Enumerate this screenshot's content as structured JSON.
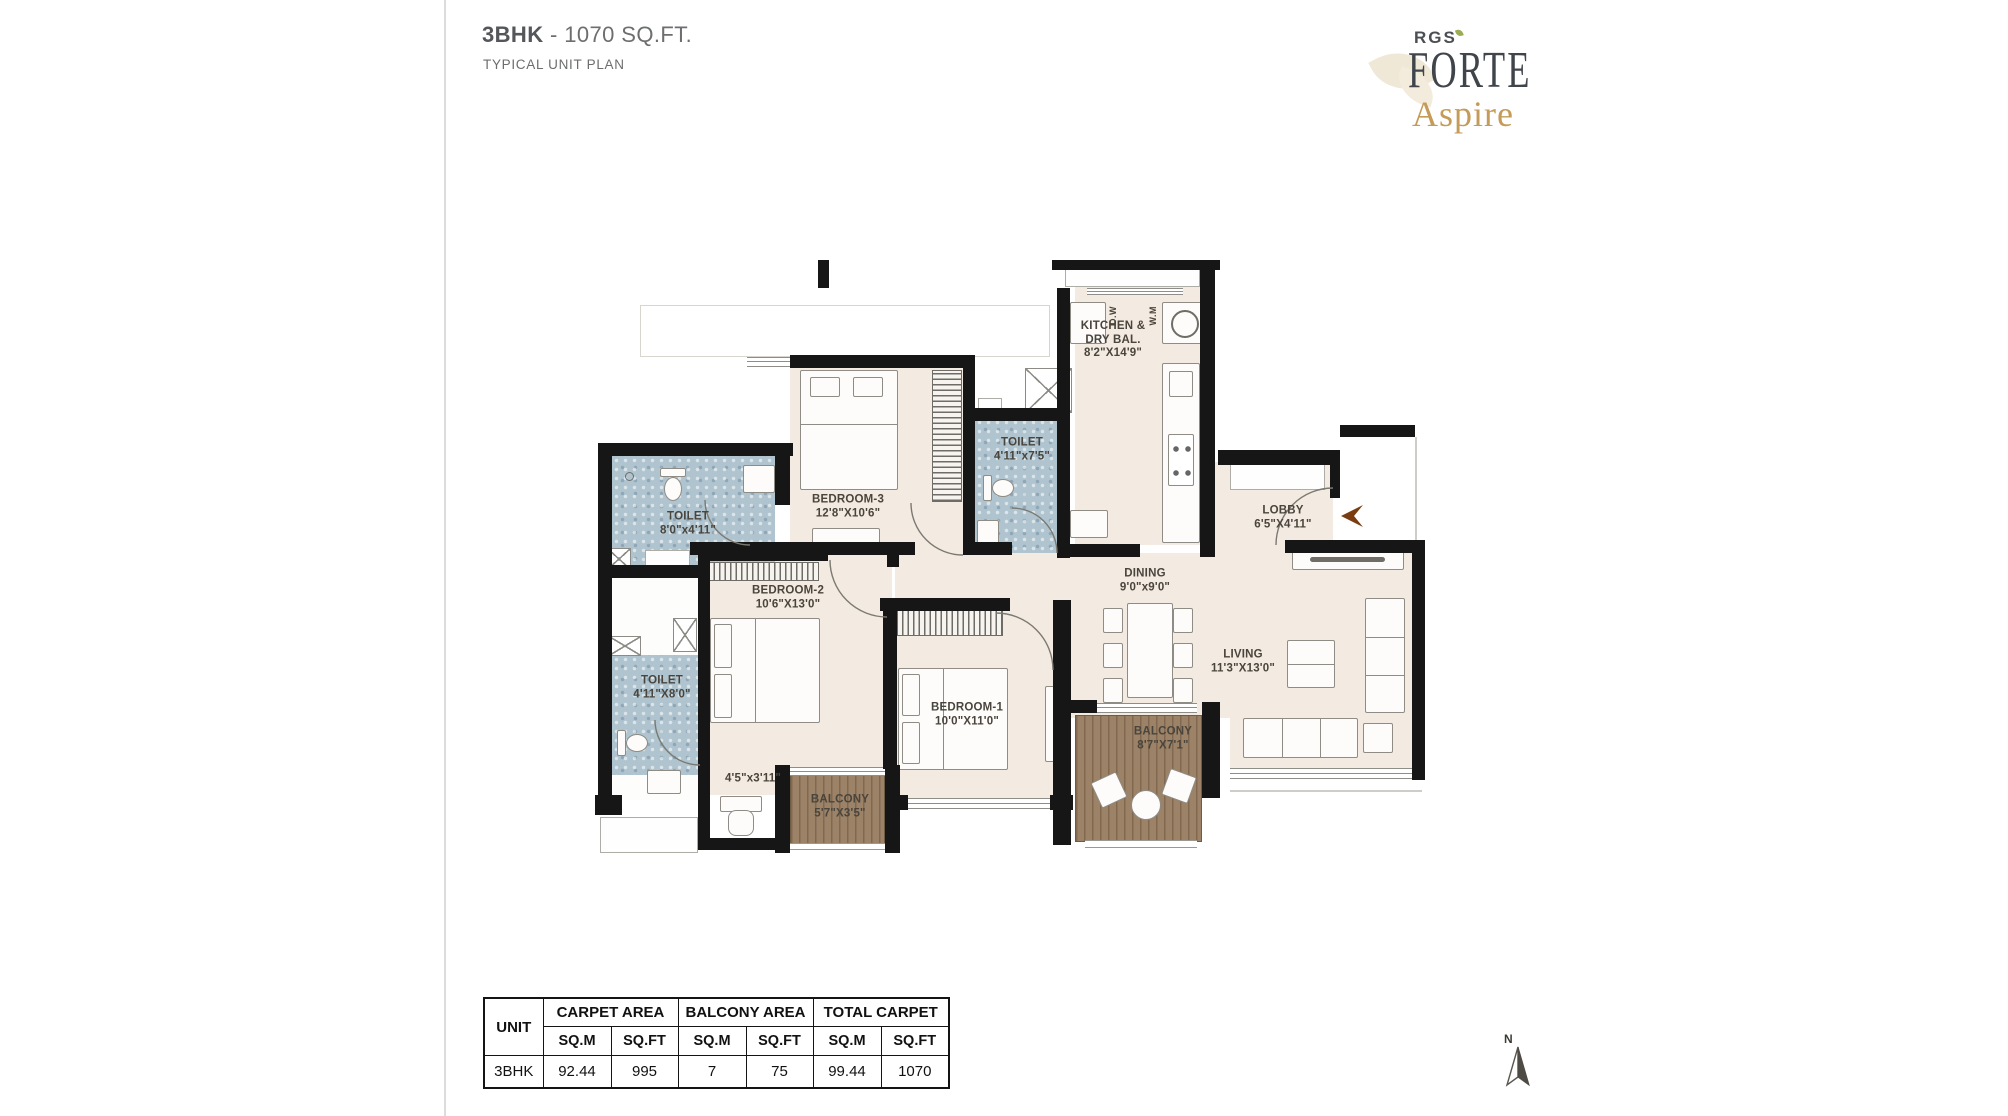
{
  "page": {
    "title_unit": "3BHK",
    "title_area": "- 1070 SQ.FT.",
    "subtitle": "TYPICAL UNIT PLAN"
  },
  "logo": {
    "rgs": "RGS",
    "forte": "FORTE",
    "aspire": "Aspire"
  },
  "plan": {
    "rooms": {
      "kitchen": {
        "line1": "KITCHEN &",
        "line2": "DRY BAL.",
        "dim": "8'2\"X14'9\""
      },
      "lobby": {
        "line1": "LOBBY",
        "dim": "6'5\"X4'11\""
      },
      "toilet_common": {
        "line1": "TOILET",
        "dim": "4'11\"x7'5\""
      },
      "bedroom3": {
        "line1": "BEDROOM-3",
        "dim": "12'8\"X10'6\""
      },
      "toilet_bed3": {
        "line1": "TOILET",
        "dim": "8'0\"x4'11\""
      },
      "bedroom2": {
        "line1": "BEDROOM-2",
        "dim": "10'6\"X13'0\""
      },
      "toilet_bed2": {
        "line1": "TOILET",
        "dim": "4'11\"X8'0\""
      },
      "dining": {
        "line1": "DINING",
        "dim": "9'0\"x9'0\""
      },
      "living": {
        "line1": "LIVING",
        "dim": "11'3\"X13'0\""
      },
      "bedroom1": {
        "line1": "BEDROOM-1",
        "dim": "10'0\"X11'0\""
      },
      "balcony_main": {
        "line1": "BALCONY",
        "dim": "8'7\"X7'1\""
      },
      "balcony_small": {
        "line1": "BALCONY",
        "dim": "5'7\"X3'5\""
      },
      "passage": {
        "dim": "4'5\"x3'11\""
      }
    },
    "appliances": {
      "dishwasher": "D.W",
      "washing_machine": "W.M"
    },
    "compass_label": "N"
  },
  "area_table": {
    "unit_header": "UNIT",
    "groups": [
      "CARPET AREA",
      "BALCONY AREA",
      "TOTAL CARPET"
    ],
    "subheaders": [
      "SQ.M",
      "SQ.FT",
      "SQ.M",
      "SQ.FT",
      "SQ.M",
      "SQ.FT"
    ],
    "row": [
      "3BHK",
      "92.44",
      "995",
      "7",
      "75",
      "99.44",
      "1070"
    ]
  },
  "colors": {
    "wall": "#161616",
    "floor_beige": "#f3eae1",
    "toilet_tile": "#afc4cf",
    "balcony_wood": "#9c8267",
    "brand_gold": "#c59b58",
    "entry_arrow": "#7a3d12"
  }
}
